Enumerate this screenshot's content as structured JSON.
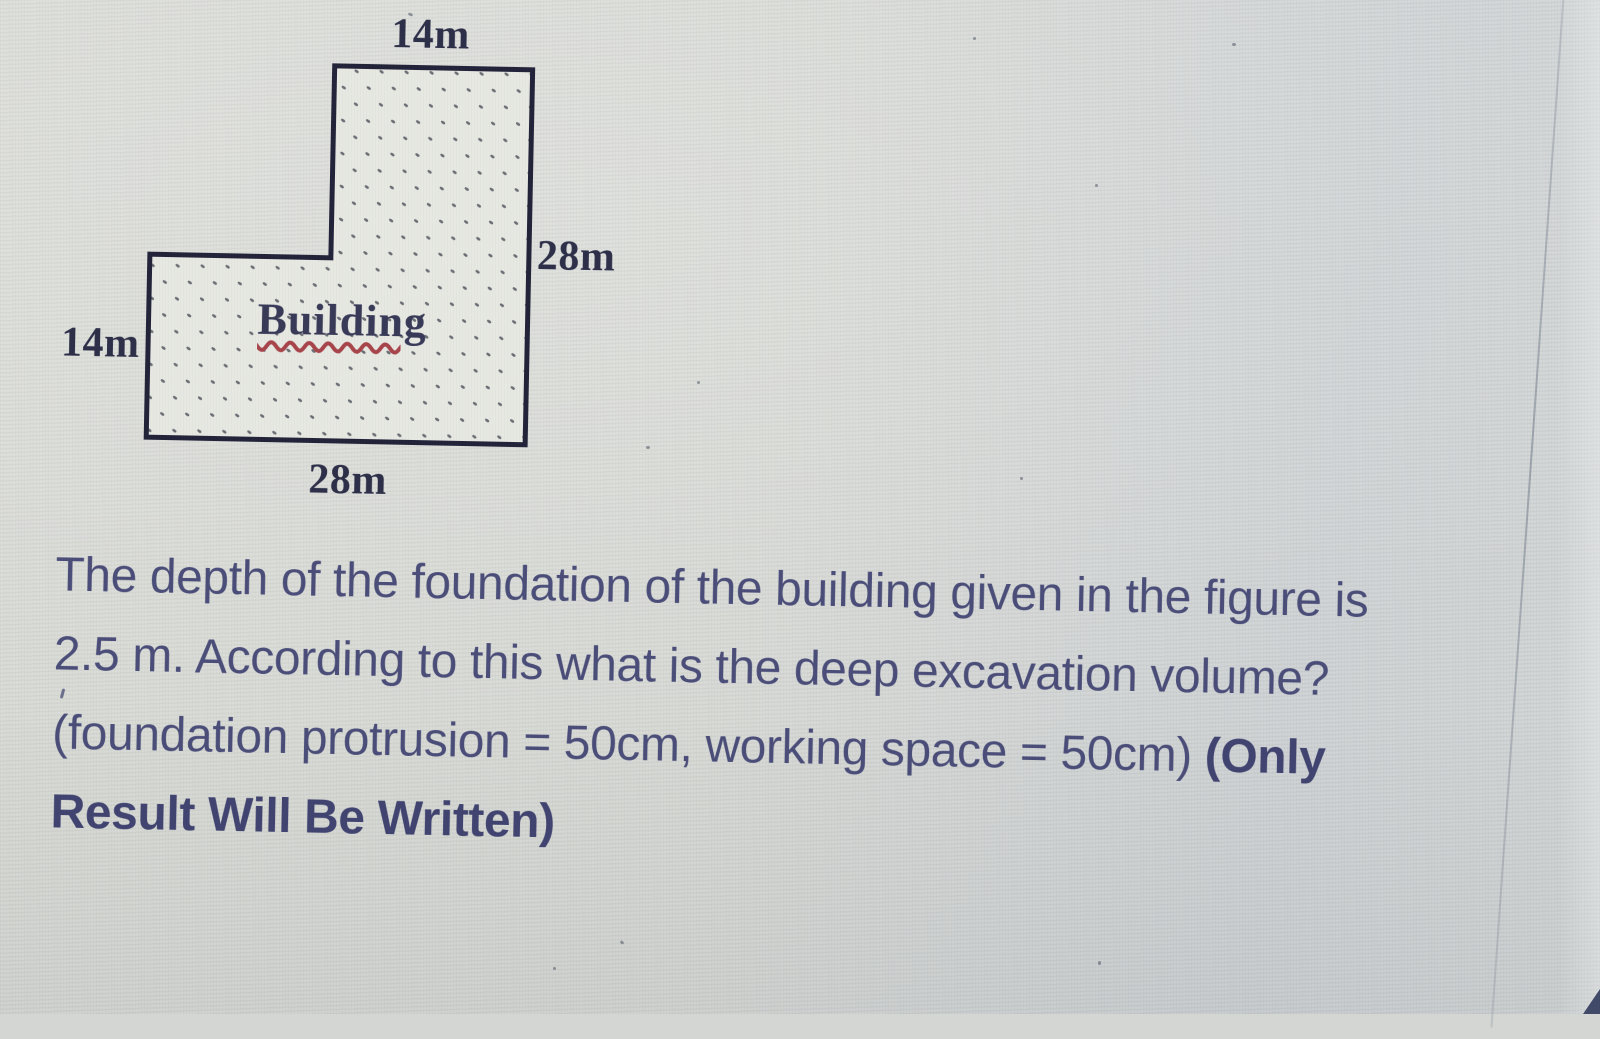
{
  "figure": {
    "building_label": "Building",
    "dimension_labels": {
      "top_width": "14m",
      "right_height": "28m",
      "left_height": "14m",
      "bottom_width": "28m"
    },
    "colors": {
      "outline": "#23243a",
      "fill": "#e7e8e2",
      "stipple_dots": "#4e535b",
      "misspell_underline": "#a8454b",
      "dimension_text": "#2e3049"
    }
  },
  "question": {
    "text_color": "#4b4e79",
    "lines": [
      "The depth of the foundation of the building given in the figure is",
      "2.5 m. According to this what is the deep excavation volume?"
    ],
    "line3_regular": "(foundation protrusion = 50cm, working space = 50cm) ",
    "line3_bold": "(Only",
    "line4_bold": "Result Will Be Written)",
    "depth_of_foundation": "2.5 m",
    "foundation_protrusion": "50cm",
    "working_space": "50cm"
  }
}
